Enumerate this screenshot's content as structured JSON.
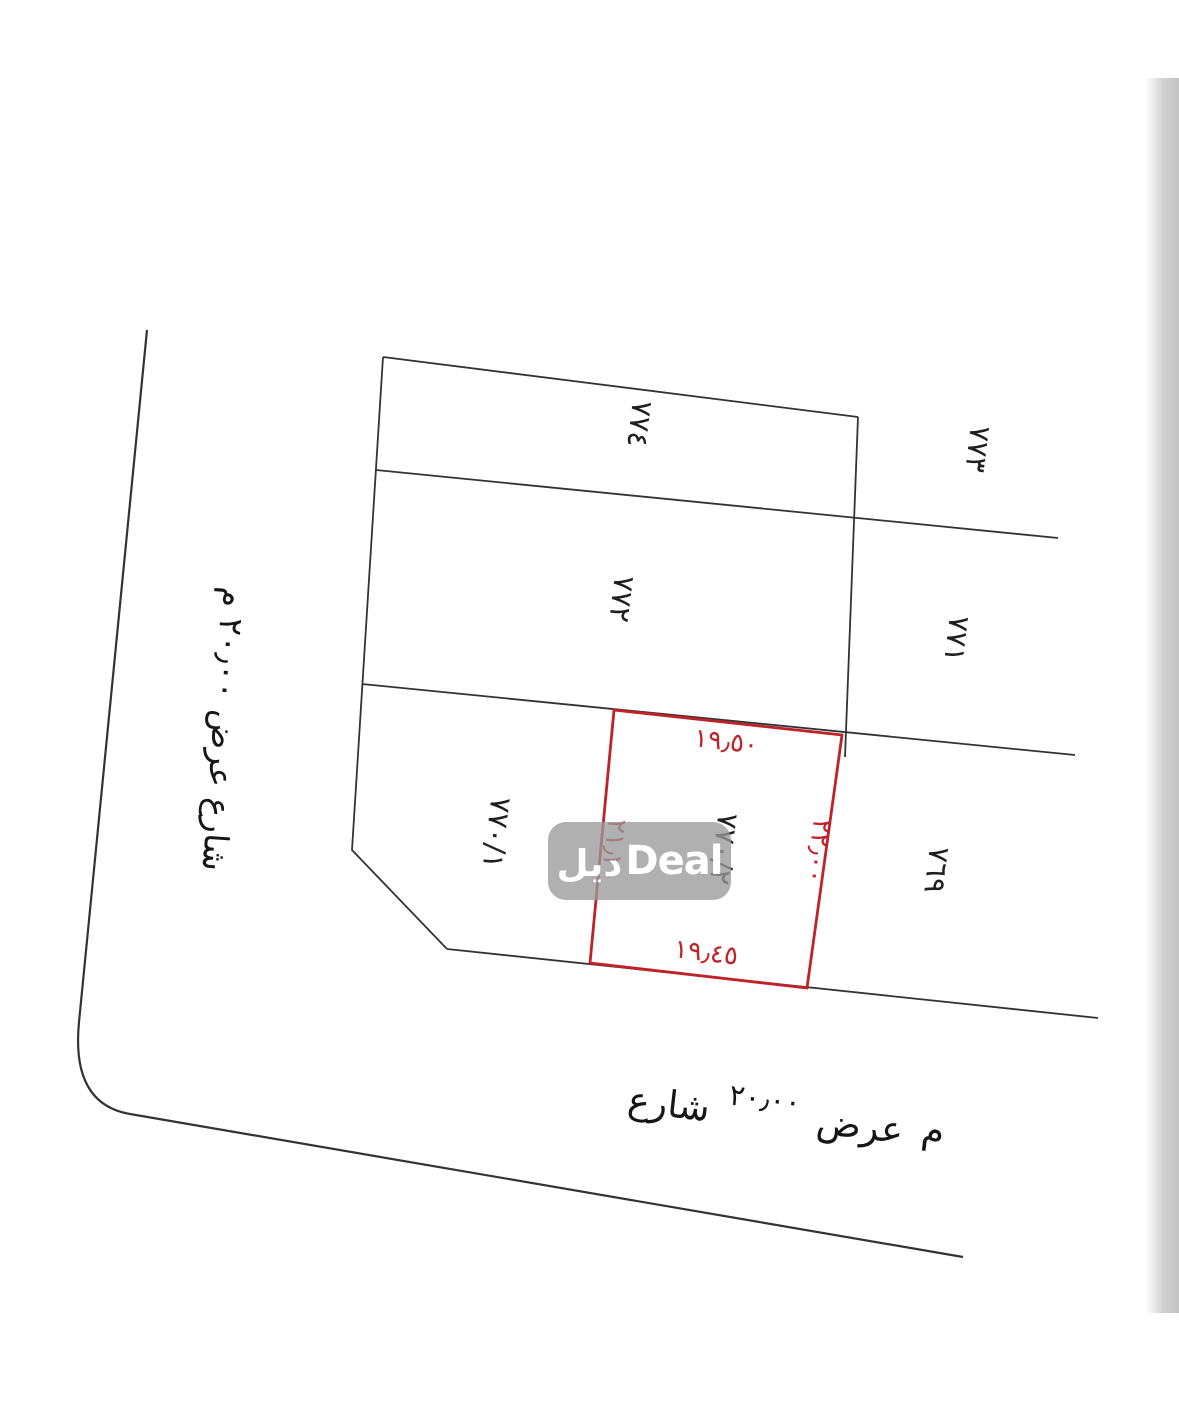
{
  "document": {
    "kind": "land survey plot plan",
    "background": "#ffffff",
    "line_color": "#333333",
    "edge_shadow_color": "#c9c9c9"
  },
  "plots": {
    "p774": "٧٧٤",
    "p773": "٧٧٣",
    "p772": "٧٧٢",
    "p771": "٧٧١",
    "p770_1": "٧٧٠/١",
    "p769": "٧٦٩"
  },
  "highlighted_plot": {
    "label": "٧٧٠/٢",
    "outline_color": "#bf2229",
    "dim_top": "١٩٫٥٠",
    "dim_bottom": "١٩٫٤٥",
    "dim_right": "٢٢٫٠٠",
    "dim_left": "٢١٫٢٠"
  },
  "streets": {
    "left_label": "شارع عرض ٢٠٫٠٠ م",
    "bottom_word1": "شارع",
    "bottom_number": "٢٠٫٠٠",
    "bottom_word2": "عرض",
    "bottom_meter": "م"
  },
  "watermark": {
    "arabic": "ديل",
    "latin": "Deal",
    "bg_color": "#9a9a9a",
    "text_color": "#ffffff"
  }
}
